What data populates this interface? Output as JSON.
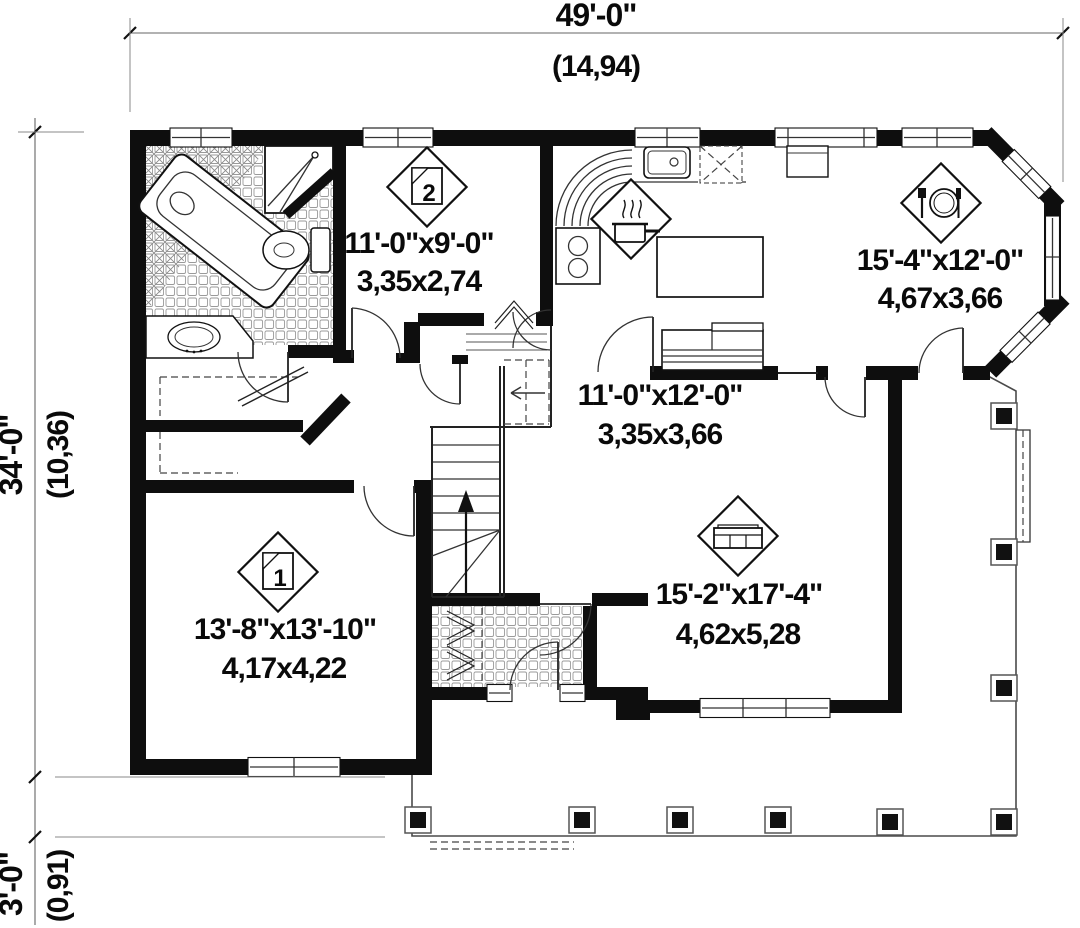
{
  "title": "First floor plan",
  "dimensions": {
    "overall_width": {
      "imperial": "49'-0\"",
      "metric": "(14,94)"
    },
    "overall_depth": {
      "imperial": "34'-0\"",
      "metric": "(10,36)"
    },
    "porch_depth": {
      "imperial": "3'-0\"",
      "metric": "(0,91)"
    }
  },
  "rooms": {
    "bedroom2": {
      "number": "2",
      "size_imperial": "11'-0\"x9'-0\"",
      "size_metric": "3,35x2,74"
    },
    "dining": {
      "size_imperial": "15'-4\"x12'-0\"",
      "size_metric": "4,67x3,66"
    },
    "family": {
      "size_imperial": "11'-0\"x12'-0\"",
      "size_metric": "3,35x3,66"
    },
    "bedroom1": {
      "number": "1",
      "size_imperial": "13'-8\"x13'-10\"",
      "size_metric": "4,17x4,22"
    },
    "living": {
      "size_imperial": "15'-2\"x17'-4\"",
      "size_metric": "4,62x5,28"
    }
  },
  "icons": {
    "bedroom": "bed-icon",
    "kitchen": "cooking-pot-icon",
    "dining": "place-setting-icon",
    "living": "sofa-icon"
  },
  "colors": {
    "wall": "#0e0e0e",
    "paper": "#ffffff",
    "line": "#333333"
  }
}
